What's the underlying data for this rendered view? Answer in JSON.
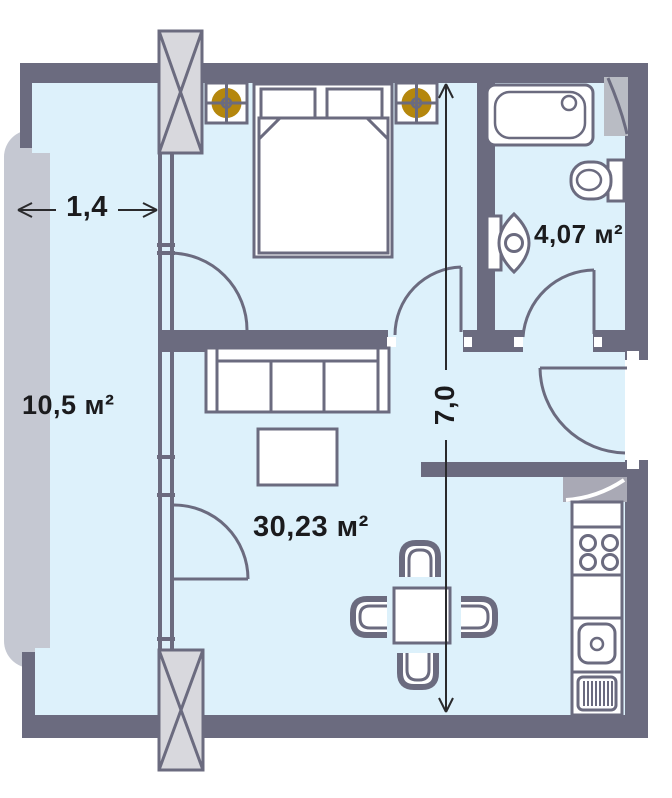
{
  "plan": {
    "title": "apartment-floor-plan",
    "rooms": {
      "balcony": {
        "area_label": "10,5 м²"
      },
      "living_room": {
        "area_label": "30,23 м²"
      },
      "bathroom": {
        "area_label": "4,07 м²"
      }
    },
    "dimensions": {
      "balcony_width_label": "1,4",
      "apartment_depth_label": "7,0"
    },
    "fixtures": [
      "double-bed",
      "ceiling-vent-symbol-left",
      "ceiling-vent-symbol-right",
      "sofa",
      "coffee-table",
      "dining-table",
      "chair-top",
      "chair-bottom",
      "chair-left",
      "chair-right",
      "bathtub",
      "toilet",
      "wash-basin",
      "stove",
      "kitchen-sink",
      "drainboard",
      "ventilation-shaft-top",
      "ventilation-shaft-bottom",
      "corner-cabinet",
      "duct-panel"
    ],
    "colors": {
      "wall": "#6b6b7f",
      "floor": "#ddf1fb",
      "fixture_fill": "#ffffff",
      "accent_gold": "#b5870d",
      "balcony_band": "#c5c8d2",
      "shaft_fill": "#d8d8dd",
      "hatch_gray": "#a9a9b5",
      "duct_gray": "#b9bcc4",
      "dimension_line": "#2a2a2c",
      "text": "#1b1b1d"
    }
  }
}
